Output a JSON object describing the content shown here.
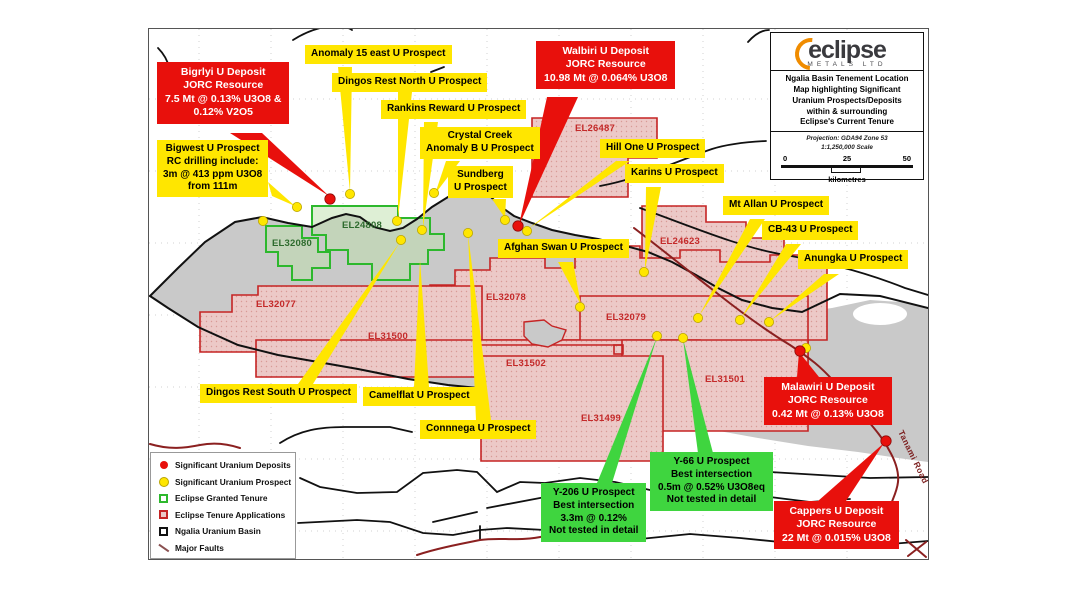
{
  "map": {
    "title_box": {
      "logo_word": "eclipse",
      "logo_sub": "METALS LTD",
      "title": "Ngalia Basin Tenement Location\nMap highlighting Significant\nUranium Prospects/Deposits\nwithin & surrounding\nEclipse's Current Tenure",
      "projection": "Projection: GDA94 Zone 53\n1:1,250,000 Scale",
      "scale_ticks": [
        "0",
        "25",
        "50"
      ],
      "scale_unit": "kilometres"
    },
    "legend": {
      "items": [
        {
          "label": "Significant Uranium Deposits",
          "type": "dot",
          "color": "#e8100c"
        },
        {
          "label": "Significant Uranium Prospect",
          "type": "dot",
          "color": "#ffe600"
        },
        {
          "label": "Eclipse Granted Tenure",
          "type": "box",
          "color": "#2db82d"
        },
        {
          "label": "Eclipse Tenure Applications",
          "type": "box",
          "color": "#c52424"
        },
        {
          "label": "Ngalia Uranium Basin",
          "type": "box",
          "color": "#111111"
        },
        {
          "label": "Major Faults",
          "type": "line",
          "color": "#8a5050"
        }
      ]
    },
    "callouts": {
      "red": [
        {
          "text": "Bigrlyi U Deposit\nJORC Resource\n7.5 Mt @ 0.13% U3O8 &\n0.12% V2O5"
        },
        {
          "text": "Walbiri U Deposit\nJORC Resource\n10.98 Mt @ 0.064% U3O8"
        },
        {
          "text": "Malawiri U Deposit\nJORC Resource\n0.42 Mt @ 0.13% U3O8"
        },
        {
          "text": "Cappers U Deposit\nJORC Resource\n22 Mt @ 0.015% U3O8"
        }
      ],
      "yellow": [
        {
          "text": "Anomaly 15 east U Prospect"
        },
        {
          "text": "Dingos Rest North U Prospect"
        },
        {
          "text": "Rankins Reward U Prospect"
        },
        {
          "text": "Crystal Creek\nAnomaly B U Prospect"
        },
        {
          "text": "Sundberg\nU Prospect"
        },
        {
          "text": "Hill One U Prospect"
        },
        {
          "text": "Karins U Prospect"
        },
        {
          "text": "Mt Allan U Prospect"
        },
        {
          "text": "CB-43 U Prospect"
        },
        {
          "text": "Anungka U Prospect"
        },
        {
          "text": "Afghan Swan U Prospect"
        },
        {
          "text": "Bigwest U Prospect\nRC drilling include:\n3m @ 413 ppm U3O8\nfrom 111m"
        },
        {
          "text": "Dingos Rest South U Prospect"
        },
        {
          "text": "Camelflat U Prospect"
        },
        {
          "text": "Connnega U Prospect"
        }
      ],
      "green": [
        {
          "text": "Y-206 U Prospect\nBest intersection\n3.3m @ 0.12%\nNot tested in detail"
        },
        {
          "text": "Y-66 U Prospect\nBest intersection\n0.5m @ 0.52% U3O8eq\nNot tested in detail"
        }
      ]
    },
    "tenement_labels": {
      "red": [
        {
          "id": "EL26487"
        },
        {
          "id": "EL24623"
        },
        {
          "id": "EL32077"
        },
        {
          "id": "EL32078"
        },
        {
          "id": "EL32079"
        },
        {
          "id": "EL31500"
        },
        {
          "id": "EL31502"
        },
        {
          "id": "EL31501"
        },
        {
          "id": "EL31499"
        }
      ],
      "green": [
        {
          "id": "EL24808"
        },
        {
          "id": "EL32080"
        }
      ]
    },
    "road_label": "Tanami Road",
    "deposits": [
      [
        330,
        199
      ],
      [
        518,
        226
      ],
      [
        800,
        351
      ],
      [
        886,
        441
      ]
    ],
    "prospects": [
      [
        263,
        221
      ],
      [
        297,
        207
      ],
      [
        350,
        194
      ],
      [
        397,
        221
      ],
      [
        401,
        240
      ],
      [
        422,
        230
      ],
      [
        434,
        193
      ],
      [
        468,
        233
      ],
      [
        505,
        220
      ],
      [
        527,
        231
      ],
      [
        580,
        307
      ],
      [
        644,
        272
      ],
      [
        657,
        336
      ],
      [
        683,
        338
      ],
      [
        698,
        318
      ],
      [
        740,
        320
      ],
      [
        769,
        322
      ],
      [
        806,
        348
      ]
    ],
    "colors": {
      "deposit_dot": "#e8100c",
      "prospect_dot": "#ffe600",
      "granted_tenure": "#2db82d",
      "tenure_application": "#c52424",
      "basin_fill": "#c9c9c9",
      "road": "#8b2020"
    }
  }
}
